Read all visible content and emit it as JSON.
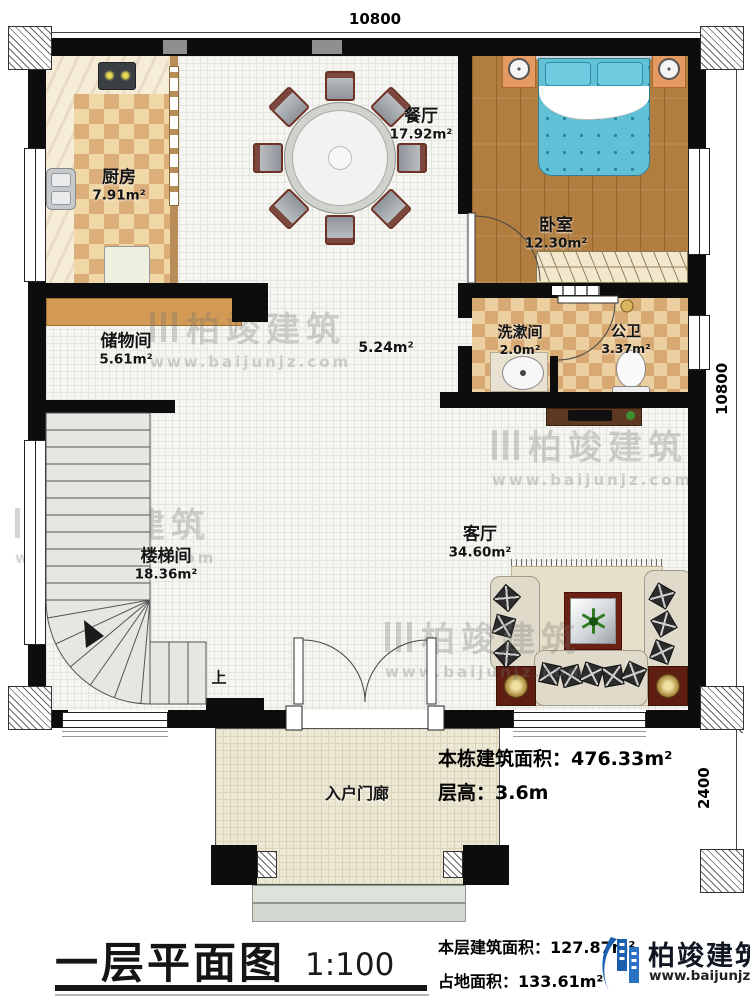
{
  "dimensions": {
    "top": "10800",
    "right": "10800",
    "porch_depth": "2400"
  },
  "rooms": {
    "kitchen": {
      "name": "厨房",
      "area": "7.91m²"
    },
    "dining": {
      "name": "餐厅",
      "area": "17.92m²"
    },
    "bedroom": {
      "name": "卧室",
      "area": "12.30m²"
    },
    "washroom": {
      "name": "洗漱间",
      "area": "2.0m²"
    },
    "toilet": {
      "name": "公卫",
      "area": "3.37m²"
    },
    "storage": {
      "name": "储物间",
      "area": "5.61m²"
    },
    "corridor": {
      "area": "5.24m²"
    },
    "stairwell": {
      "name": "楼梯间",
      "area": "18.36m²"
    },
    "living": {
      "name": "客厅",
      "area": "34.60m²"
    },
    "porch": {
      "name": "入户门廊"
    }
  },
  "stairs": {
    "direction_label": "上"
  },
  "notes": {
    "total_building_area": "本栋建筑面积：476.33m²",
    "floor_height": "层高：3.6m"
  },
  "footer": {
    "title": "一层平面图",
    "scale": "1:100",
    "floor_area": "本层建筑面积：127.87m²",
    "land_area": "占地面积：133.61m²"
  },
  "brand": {
    "name": "柏竣建筑",
    "website": "www.baijunjz.com"
  },
  "watermark": {
    "name": "柏竣建筑",
    "website": "www.baijunjz.com"
  },
  "colors": {
    "wall": "#0d0d0d",
    "wood_floor": "#b27e40",
    "tile": "#e9cb97",
    "bed": "#5fc0d6",
    "stairs": "#e4e8e0",
    "brand_blue": "#1c5fae"
  }
}
